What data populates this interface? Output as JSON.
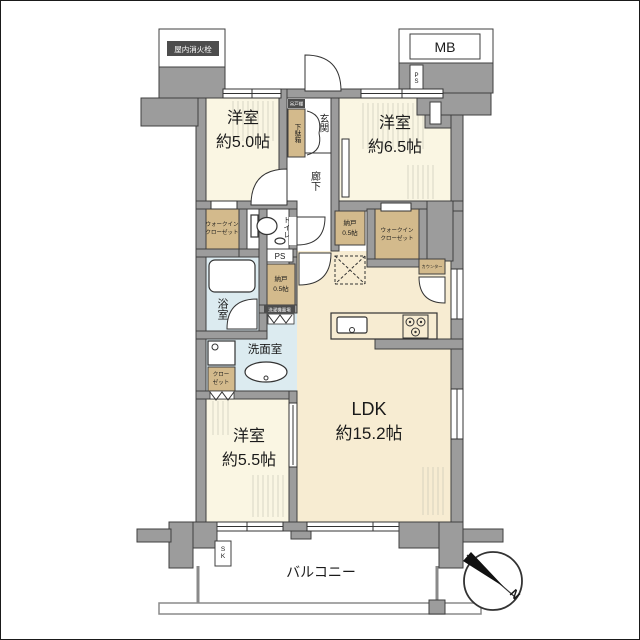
{
  "colors": {
    "wall": "#9c9c9c",
    "room_floor": "#faf6e3",
    "ldk_floor": "#f7ecd2",
    "closet_fill": "#d3ba8c",
    "wet_area": "#dcebf0",
    "badge": "#4d4d4d"
  },
  "rooms": {
    "bedroom_nw": {
      "name": "洋室",
      "size": "約5.0帖"
    },
    "bedroom_ne": {
      "name": "洋室",
      "size": "約6.5帖"
    },
    "bedroom_sw": {
      "name": "洋室",
      "size": "約5.5帖"
    },
    "ldk": {
      "name": "LDK",
      "size": "約15.2帖"
    },
    "entrance": "玄関",
    "corridor": "廊下",
    "bathroom": "浴室",
    "washroom": "洗面室",
    "toilet": "トイレ",
    "balcony": "バルコニー"
  },
  "storage": {
    "wic_west": {
      "line1": "ウォークイン",
      "line2": "クローゼット"
    },
    "wic_east": {
      "line1": "ウォークイン",
      "line2": "クローゼット"
    },
    "nando_center": {
      "name": "納戸",
      "size": "0.5帖"
    },
    "nando_east": {
      "name": "納戸",
      "size": "0.5帖"
    },
    "closet_sw": {
      "line1": "クロー",
      "line2": "ゼット"
    },
    "shoe_cabinet": "下駄箱",
    "shoe_cabinet_top": "吊戸棚",
    "counter": "カウンター"
  },
  "facilities": {
    "meter_box": "MB",
    "pipe_space_top": "PS",
    "pipe_space": "PS",
    "slop_sink": "SK",
    "fire_hydrant": "屋内消火栓",
    "laundry_space": "洗濯機置場"
  },
  "compass": {
    "north": "N"
  }
}
